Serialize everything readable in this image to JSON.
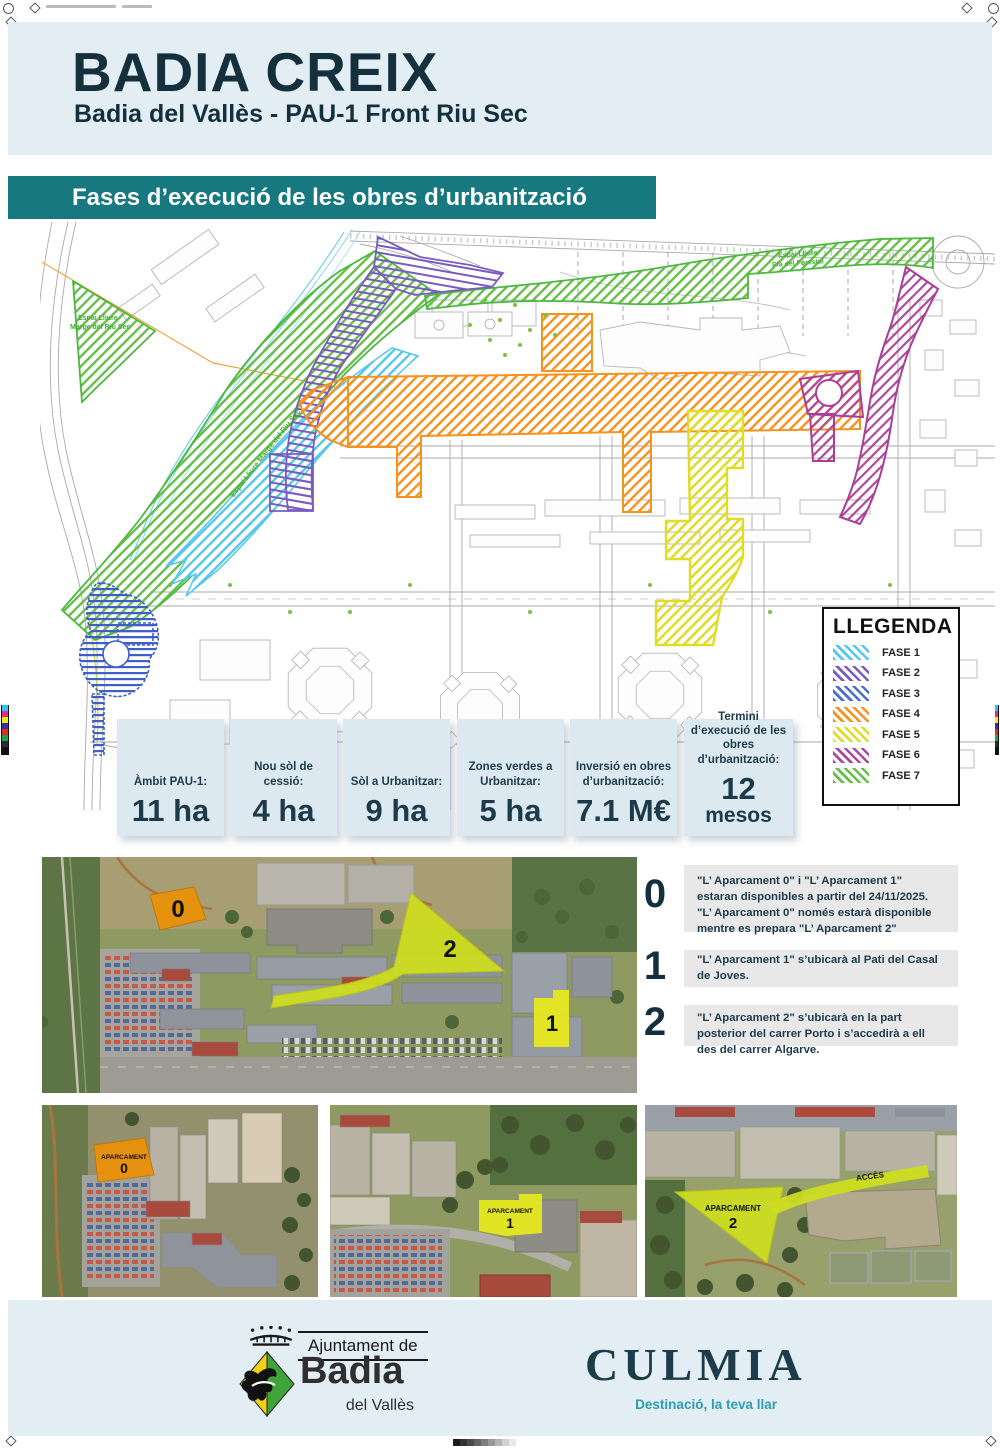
{
  "header": {
    "title": "BADIA CREIX",
    "subtitle": "Badia del Vallès - PAU-1 Front Riu Sec"
  },
  "section": {
    "title": "Fases d’execució de les obres d’urbanització"
  },
  "map": {
    "legend": {
      "title": "LLEGENDA",
      "items": [
        {
          "label": "FASE 1",
          "color": "#55c7ea"
        },
        {
          "label": "FASE 2",
          "color": "#7a5bbf"
        },
        {
          "label": "FASE 3",
          "color": "#4a6ed0"
        },
        {
          "label": "FASE 4",
          "color": "#f6921e"
        },
        {
          "label": "FASE 5",
          "color": "#dfdc2a"
        },
        {
          "label": "FASE 6",
          "color": "#ae4a9c"
        },
        {
          "label": "FASE 7",
          "color": "#67bf4a"
        }
      ]
    },
    "labels": {
      "green_area_1a": "Espai Lliure",
      "green_area_1b": "Marge del Riu Sec",
      "river_band": "Espai Lliure Marge del Riu Sec",
      "green_area_2a": "Espai Lliure",
      "green_area_2b": "Pla del Forestal"
    }
  },
  "stats": {
    "items": [
      {
        "label": "Àmbit PAU-1:",
        "value": "11 ha"
      },
      {
        "label": "Nou sòl de cessió:",
        "value": "4 ha"
      },
      {
        "label": "Sòl a Urbanitzar:",
        "value": "9 ha"
      },
      {
        "label": "Zones verdes a Urbanitzar:",
        "value": "5 ha"
      },
      {
        "label": "Inversió en obres d’urbanització:",
        "value": "7.1 M€"
      },
      {
        "label": "Termini d’execució de les obres d’urbanització:",
        "value": "12",
        "value2": "mesos"
      }
    ]
  },
  "parking_plan": {
    "markers": {
      "m0": "0",
      "m1": "1",
      "m2": "2"
    },
    "notes": [
      {
        "num": "0",
        "text": "\"L’ Aparcament 0\" i \"L’ Aparcament 1\" estaran disponibles a partir del 24/11/2025. \"L’ Aparcament 0\" només estarà disponible mentre es prepara \"L’ Aparcament 2\""
      },
      {
        "num": "1",
        "text": "\"L’ Aparcament 1\" s’ubicarà al Pati del Casal de Joves."
      },
      {
        "num": "2",
        "text": "\"L’ Aparcament 2\" s’ubicarà en la part posterior del carrer Porto i s’accedirà a ell des del carrer Algarve."
      }
    ]
  },
  "photos": [
    {
      "title": "APARCAMENT",
      "num": "0"
    },
    {
      "title": "APARCAMENT",
      "num": "1"
    },
    {
      "title": "APARCAMENT",
      "num": "2",
      "access_label": "ACCÈS"
    }
  ],
  "footer": {
    "org_pre": "Ajuntament de",
    "org_name": "Badia",
    "org_sub": "del Vallès",
    "brand": "CULMIA",
    "brand_tagline": "Destinació, la teva llar"
  }
}
